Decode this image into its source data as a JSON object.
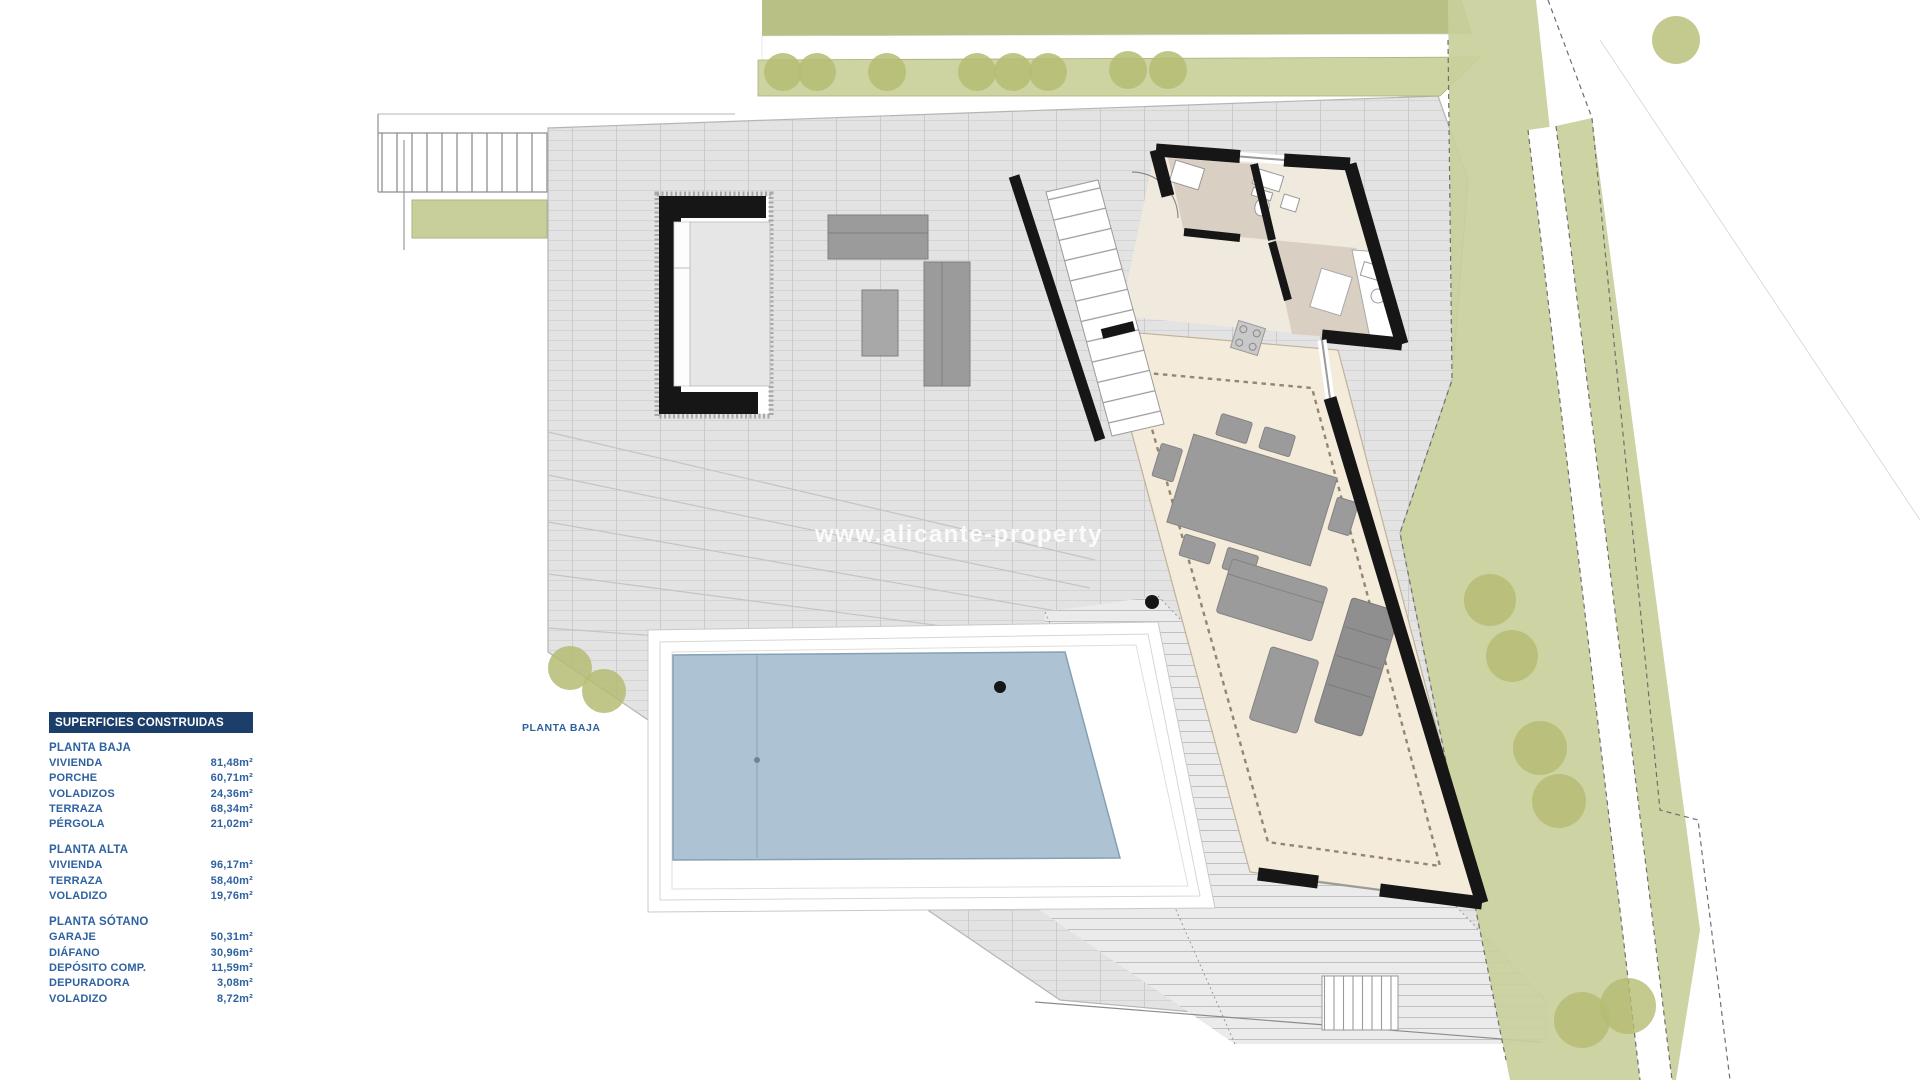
{
  "plan": {
    "floor_label": "PLANTA BAJA"
  },
  "watermark": {
    "text": "www.alicante-property"
  },
  "legend": {
    "title": "SUPERFICIES CONSTRUIDAS",
    "sections": [
      {
        "name": "PLANTA BAJA",
        "rows": [
          {
            "label": "VIVIENDA",
            "value": "81,48m²"
          },
          {
            "label": "PORCHE",
            "value": "60,71m²"
          },
          {
            "label": "VOLADIZOS",
            "value": "24,36m²"
          },
          {
            "label": "TERRAZA",
            "value": "68,34m²"
          },
          {
            "label": "PÉRGOLA",
            "value": "21,02m²"
          }
        ]
      },
      {
        "name": "PLANTA ALTA",
        "rows": [
          {
            "label": "VIVIENDA",
            "value": "96,17m²"
          },
          {
            "label": "TERRAZA",
            "value": "58,40m²"
          },
          {
            "label": "VOLADIZO",
            "value": "19,76m²"
          }
        ]
      },
      {
        "name": "PLANTA SÓTANO",
        "rows": [
          {
            "label": "GARAJE",
            "value": "50,31m²"
          },
          {
            "label": "DIÁFANO",
            "value": "30,96m²"
          },
          {
            "label": "DEPÓSITO COMP.",
            "value": "11,59m²"
          },
          {
            "label": "DEPURADORA",
            "value": "3,08m²"
          },
          {
            "label": "VOLADIZO",
            "value": "8,72m²"
          }
        ]
      }
    ]
  },
  "colors": {
    "legend_header_bg": "#1c3e6b",
    "legend_text": "#2e61a0",
    "terrain": "#e3e3e3",
    "pool": "#adc3d3",
    "garden_olive": "#c9cf9b",
    "house_floor_cream": "#f4ebda",
    "house_floor_taupe": "#d9cfc3",
    "walls": "#161616",
    "furniture": "#9b9b9b"
  }
}
